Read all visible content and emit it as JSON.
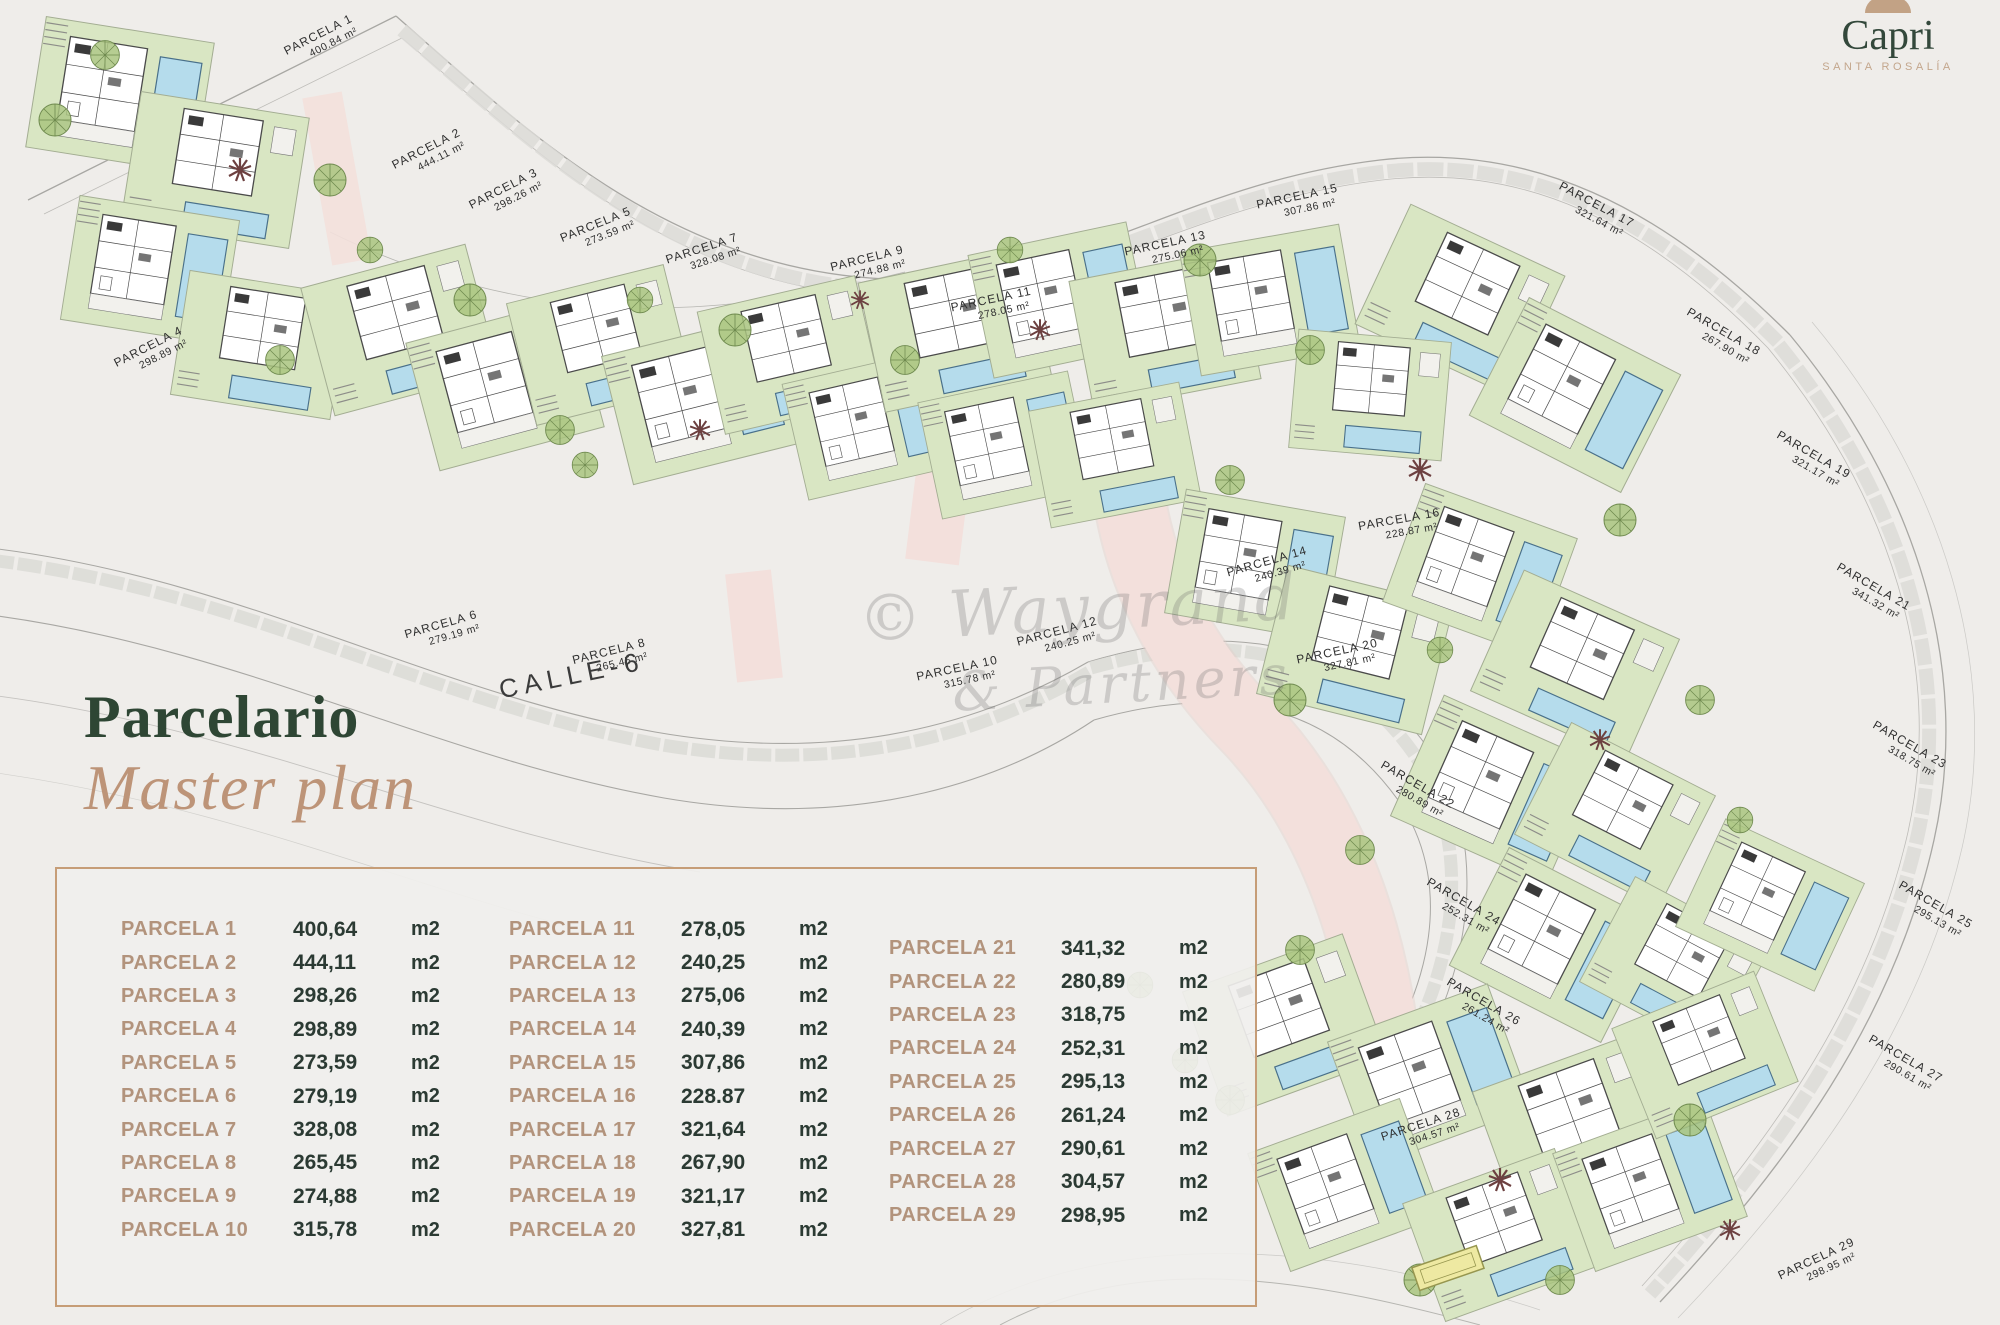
{
  "logo": {
    "name": "Capri",
    "subtitle": "SANTA ROSALÍA",
    "icon": "arch-icon"
  },
  "heading": {
    "title": "Parcelario",
    "subtitle": "Master plan"
  },
  "plan": {
    "street_label": "CALLE-6",
    "watermark_line1": "© Waygrand",
    "watermark_line2": "& Partners",
    "parcels": [
      {
        "label": "PARCELA 1",
        "area": "400.84 m²",
        "x": 320,
        "y": 38,
        "rot": -27
      },
      {
        "label": "PARCELA 2",
        "area": "444.11 m²",
        "x": 428,
        "y": 152,
        "rot": -27
      },
      {
        "label": "PARCELA 3",
        "area": "298.26 m²",
        "x": 505,
        "y": 192,
        "rot": -27
      },
      {
        "label": "PARCELA 4",
        "area": "298.89 m²",
        "x": 150,
        "y": 350,
        "rot": -27
      },
      {
        "label": "PARCELA 5",
        "area": "273.59 m²",
        "x": 597,
        "y": 228,
        "rot": -22
      },
      {
        "label": "PARCELA 6",
        "area": "279.19 m²",
        "x": 442,
        "y": 628,
        "rot": -16
      },
      {
        "label": "PARCELA 7",
        "area": "328.08 m²",
        "x": 703,
        "y": 252,
        "rot": -18
      },
      {
        "label": "PARCELA 8",
        "area": "265.45 m²",
        "x": 610,
        "y": 655,
        "rot": -14
      },
      {
        "label": "PARCELA 9",
        "area": "274.88 m²",
        "x": 868,
        "y": 262,
        "rot": -14
      },
      {
        "label": "PARCELA 10",
        "area": "315.78 m²",
        "x": 958,
        "y": 672,
        "rot": -12
      },
      {
        "label": "PARCELA 11",
        "area": "278.05 m²",
        "x": 992,
        "y": 303,
        "rot": -12
      },
      {
        "label": "PARCELA 12",
        "area": "240.25 m²",
        "x": 1058,
        "y": 635,
        "rot": -15
      },
      {
        "label": "PARCELA 13",
        "area": "275.06 m²",
        "x": 1166,
        "y": 247,
        "rot": -12
      },
      {
        "label": "PARCELA 14",
        "area": "240.39 m²",
        "x": 1268,
        "y": 565,
        "rot": -16
      },
      {
        "label": "PARCELA 15",
        "area": "307.86 m²",
        "x": 1298,
        "y": 200,
        "rot": -12
      },
      {
        "label": "PARCELA 16",
        "area": "228.87 m²",
        "x": 1400,
        "y": 523,
        "rot": -10
      },
      {
        "label": "PARCELA 17",
        "area": "321.64 m²",
        "x": 1595,
        "y": 208,
        "rot": 28
      },
      {
        "label": "PARCELA 18",
        "area": "267.90 m²",
        "x": 1722,
        "y": 335,
        "rot": 30
      },
      {
        "label": "PARCELA 19",
        "area": "321.17 m²",
        "x": 1812,
        "y": 458,
        "rot": 30
      },
      {
        "label": "PARCELA 20",
        "area": "327.81 m²",
        "x": 1338,
        "y": 655,
        "rot": -12
      },
      {
        "label": "PARCELA 21",
        "area": "341.32 m²",
        "x": 1872,
        "y": 590,
        "rot": 30
      },
      {
        "label": "PARCELA 22",
        "area": "280.89 m²",
        "x": 1416,
        "y": 788,
        "rot": 30
      },
      {
        "label": "PARCELA 23",
        "area": "318.75 m²",
        "x": 1908,
        "y": 748,
        "rot": 30
      },
      {
        "label": "PARCELA 24",
        "area": "252.31 m²",
        "x": 1462,
        "y": 905,
        "rot": 30
      },
      {
        "label": "PARCELA 25",
        "area": "295.13 m²",
        "x": 1934,
        "y": 908,
        "rot": 30
      },
      {
        "label": "PARCELA 26",
        "area": "261.24 m²",
        "x": 1482,
        "y": 1005,
        "rot": 30
      },
      {
        "label": "PARCELA 27",
        "area": "290.61 m²",
        "x": 1904,
        "y": 1062,
        "rot": 30
      },
      {
        "label": "PARCELA 28",
        "area": "304.57 m²",
        "x": 1422,
        "y": 1128,
        "rot": -18
      },
      {
        "label": "PARCELA 29",
        "area": "298.95 m²",
        "x": 1818,
        "y": 1262,
        "rot": -25
      }
    ]
  },
  "table": {
    "unit_label": "m2",
    "columns": [
      [
        {
          "label": "PARCELA 1",
          "value": "400,64"
        },
        {
          "label": "PARCELA 2",
          "value": "444,11"
        },
        {
          "label": "PARCELA 3",
          "value": "298,26"
        },
        {
          "label": "PARCELA 4",
          "value": "298,89"
        },
        {
          "label": "PARCELA 5",
          "value": "273,59"
        },
        {
          "label": "PARCELA 6",
          "value": "279,19"
        },
        {
          "label": "PARCELA 7",
          "value": "328,08"
        },
        {
          "label": "PARCELA 8",
          "value": "265,45"
        },
        {
          "label": "PARCELA 9",
          "value": "274,88"
        },
        {
          "label": "PARCELA 10",
          "value": "315,78"
        }
      ],
      [
        {
          "label": "PARCELA 11",
          "value": "278,05"
        },
        {
          "label": "PARCELA 12",
          "value": "240,25"
        },
        {
          "label": "PARCELA 13",
          "value": "275,06"
        },
        {
          "label": "PARCELA 14",
          "value": "240,39"
        },
        {
          "label": "PARCELA 15",
          "value": "307,86"
        },
        {
          "label": "PARCELA 16",
          "value": "228.87"
        },
        {
          "label": "PARCELA 17",
          "value": "321,64"
        },
        {
          "label": "PARCELA 18",
          "value": "267,90"
        },
        {
          "label": "PARCELA 19",
          "value": "321,17"
        },
        {
          "label": "PARCELA 20",
          "value": "327,81"
        }
      ],
      [
        {
          "label": "PARCELA 21",
          "value": "341,32"
        },
        {
          "label": "PARCELA 22",
          "value": "280,89"
        },
        {
          "label": "PARCELA 23",
          "value": "318,75"
        },
        {
          "label": "PARCELA 24",
          "value": "252,31"
        },
        {
          "label": "PARCELA 25",
          "value": "295,13"
        },
        {
          "label": "PARCELA 26",
          "value": "261,24"
        },
        {
          "label": "PARCELA 27",
          "value": "290,61"
        },
        {
          "label": "PARCELA 28",
          "value": "304,57"
        },
        {
          "label": "PARCELA 29",
          "value": "298,95"
        }
      ]
    ]
  },
  "colors": {
    "bg": "#efedea",
    "brand_green": "#2e4634",
    "tan": "#bd9478",
    "tan_label": "#b2937c",
    "table_border": "#c69d77",
    "ink": "#2b3a33",
    "pool": "#b5dcec",
    "garden": "#d9e6c3",
    "path_pink": "#f3e0dc",
    "road": "#a8a7a3",
    "label_ink": "#2f2f2f"
  }
}
